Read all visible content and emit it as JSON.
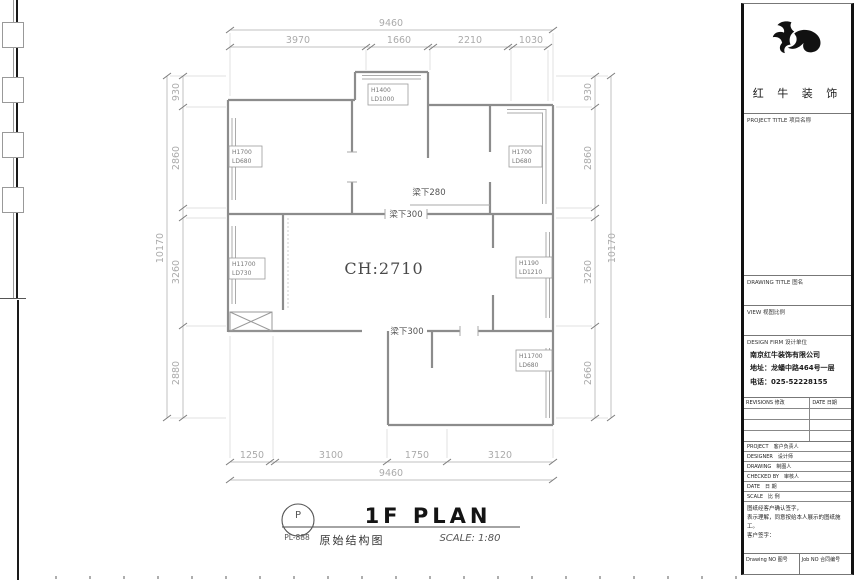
{
  "plan": {
    "dims": {
      "top_total": "9460",
      "top_segments": [
        "3970",
        "1660",
        "2210",
        "1030"
      ],
      "bottom_total": "9460",
      "bottom_segments": [
        "1250",
        "3100",
        "1750",
        "3120"
      ],
      "left_total": "10170",
      "left_segments": [
        "930",
        "2860",
        "3260",
        "2880"
      ],
      "right_total": "10170",
      "right_segments": [
        "930",
        "2860",
        "3260",
        "2660"
      ]
    },
    "room_height": "CH:2710",
    "beam_labels": {
      "top": "梁下280",
      "middle": "梁下300",
      "bottom": "梁下300"
    },
    "window_tags": {
      "top_left": {
        "l1": "H1700",
        "l2": "LD680"
      },
      "top_center": {
        "l1": "H1400",
        "l2": "LD1000"
      },
      "top_right": {
        "l1": "H1700",
        "l2": "LD680"
      },
      "mid_left": {
        "l1": "H11700",
        "l2": "LD730"
      },
      "mid_right": {
        "l1": "H1190",
        "l2": "LD1210"
      },
      "bottom_right": {
        "l1": "H11700",
        "l2": "LD680"
      }
    },
    "title": {
      "name": "1F PLAN",
      "scale": "SCALE: 1:80",
      "callout_letter": "P",
      "callout_code": "PL-888",
      "drawing_name": "原始结构图"
    }
  },
  "titleblock": {
    "brand": "红 牛 装 饰",
    "sections": {
      "project_title": "PROJECT TITLE  项目名称",
      "drawing_title": "DRAWING TITLE  图名",
      "view": "VIEW  视图比例",
      "design_firm": "DESIGN FIRM  设计单位"
    },
    "company": {
      "name": "南京红牛装饰有限公司",
      "address": "地址：龙蟠中路464号一层",
      "phone": "电话：025-52228155"
    },
    "revisions": {
      "header_left": "REVISIONS 修改",
      "header_right": "DATE 日期"
    },
    "rows": [
      {
        "en": "PROJECT",
        "zh": "客户负责人"
      },
      {
        "en": "DESIGNER",
        "zh": "设计师"
      },
      {
        "en": "DRAWING",
        "zh": "制图人"
      },
      {
        "en": "CHECKED BY",
        "zh": "审核人"
      },
      {
        "en": "DATE",
        "zh": "日 期"
      },
      {
        "en": "SCALE",
        "zh": "比 例"
      }
    ],
    "note_lines": [
      "图纸经客户确认签字，",
      "表示理解，同意按给本人展示的图纸施工。",
      "客户签字："
    ],
    "footer": {
      "left": "Drawing NO  图号",
      "right": "Job NO  合同编号"
    }
  }
}
